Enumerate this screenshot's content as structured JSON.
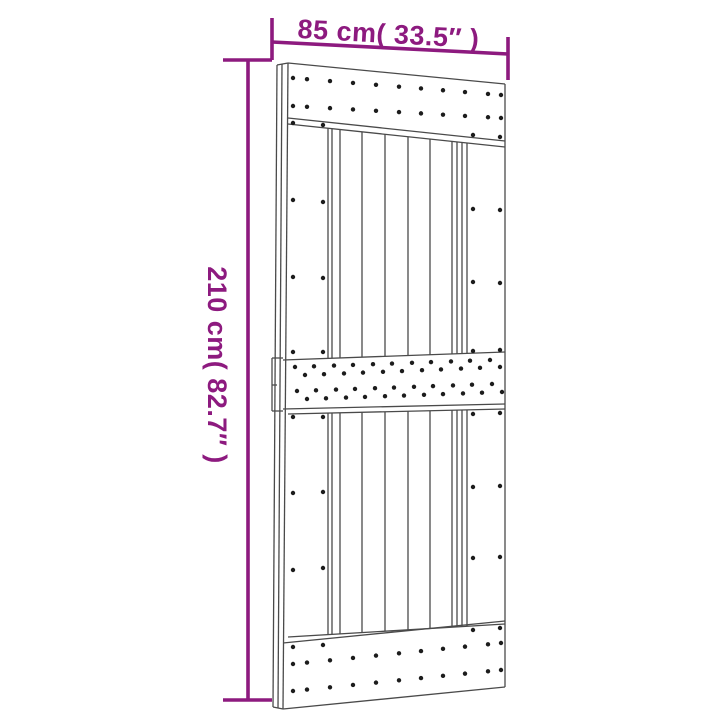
{
  "page": {
    "background": "#ffffff",
    "subject": "sliding-barn-door-dimension-diagram"
  },
  "dimensions": {
    "annotation_color": "#8d1a7f",
    "line_width": 3.6,
    "width_label": "85 cm( 33.5″ )",
    "height_label": "210 cm( 82.7″ )",
    "lines": [
      [
        272,
        42,
        508,
        54
      ],
      [
        272,
        18,
        272,
        60
      ],
      [
        508,
        37,
        508,
        80
      ],
      [
        248,
        60,
        248,
        700
      ],
      [
        223,
        60,
        272,
        60
      ],
      [
        223,
        700,
        272,
        700
      ]
    ]
  },
  "figure": {
    "name": "barn-door-line-drawing",
    "line_color": "#4a4a4a",
    "line_width": 1.3,
    "dot_color": "#1c1c1c",
    "dot_radius": 2.2,
    "door_lines": [
      [
        288,
        63,
        505,
        84
      ],
      [
        505,
        84,
        505,
        687
      ],
      [
        505,
        687,
        283,
        709
      ],
      [
        288,
        63,
        283,
        709
      ],
      [
        277,
        65,
        273,
        707
      ],
      [
        282,
        64,
        278,
        708
      ],
      [
        277,
        65,
        288,
        63
      ],
      [
        273,
        707,
        283,
        709
      ],
      [
        288,
        118,
        505,
        141
      ],
      [
        288,
        124,
        505,
        147
      ],
      [
        283,
        360,
        505,
        352
      ],
      [
        283,
        409,
        505,
        404
      ],
      [
        288,
        414,
        505,
        409
      ],
      [
        283,
        643,
        505,
        621
      ],
      [
        288,
        637,
        505,
        624
      ],
      [
        272,
        358,
        283,
        358
      ],
      [
        272,
        411,
        283,
        411
      ],
      [
        272,
        358,
        272,
        411
      ],
      [
        272,
        385,
        277,
        385
      ],
      [
        328,
        128,
        328,
        358
      ],
      [
        332,
        129,
        332,
        358
      ],
      [
        340,
        130,
        340,
        358
      ],
      [
        362,
        132,
        362,
        357
      ],
      [
        385,
        134,
        385,
        356
      ],
      [
        408,
        137,
        408,
        356
      ],
      [
        430,
        139,
        430,
        355
      ],
      [
        452,
        141,
        452,
        354
      ],
      [
        457,
        142,
        457,
        354
      ],
      [
        462,
        142,
        462,
        354
      ],
      [
        467,
        143,
        467,
        353
      ],
      [
        328,
        413,
        328,
        635
      ],
      [
        332,
        413,
        332,
        634
      ],
      [
        340,
        413,
        340,
        634
      ],
      [
        362,
        412,
        362,
        632
      ],
      [
        385,
        412,
        385,
        631
      ],
      [
        408,
        411,
        408,
        630
      ],
      [
        430,
        411,
        430,
        628
      ],
      [
        452,
        410,
        452,
        627
      ],
      [
        457,
        410,
        457,
        627
      ],
      [
        462,
        410,
        462,
        626
      ],
      [
        467,
        410,
        467,
        626
      ]
    ],
    "nail_rows": [
      {
        "xs": [
          293,
          307,
          330,
          353,
          376,
          399,
          421,
          443,
          465,
          488,
          501
        ],
        "y_first": 78,
        "y_last": 95
      },
      {
        "xs": [
          293,
          307,
          330,
          353,
          376,
          399,
          421,
          443,
          465,
          488,
          501
        ],
        "y_first": 106,
        "y_last": 118
      },
      {
        "xs": [
          293,
          307,
          330,
          353,
          376,
          399,
          421,
          443,
          465,
          488,
          501
        ],
        "y_first": 664,
        "y_last": 643
      },
      {
        "xs": [
          293,
          307,
          330,
          353,
          376,
          399,
          421,
          443,
          465,
          488,
          501
        ],
        "y_first": 691,
        "y_last": 670
      },
      {
        "xs": [
          295,
          314,
          334,
          353,
          373,
          392,
          412,
          431,
          451,
          470,
          490
        ],
        "y_first": 367,
        "y_last": 360
      },
      {
        "xs": [
          305,
          324,
          344,
          363,
          383,
          402,
          422,
          441,
          461,
          480,
          500
        ],
        "y_first": 375,
        "y_last": 367
      },
      {
        "xs": [
          297,
          316,
          336,
          355,
          375,
          394,
          414,
          433,
          453,
          472,
          492
        ],
        "y_first": 391,
        "y_last": 384
      },
      {
        "xs": [
          307,
          326,
          346,
          365,
          385,
          404,
          424,
          443,
          463,
          482,
          502
        ],
        "y_first": 399,
        "y_last": 392
      }
    ],
    "nail_dots": [
      [
        293,
        123
      ],
      [
        323,
        125
      ],
      [
        293,
        200
      ],
      [
        323,
        202
      ],
      [
        293,
        277
      ],
      [
        323,
        278
      ],
      [
        293,
        352
      ],
      [
        323,
        352
      ],
      [
        473,
        135
      ],
      [
        500,
        137
      ],
      [
        473,
        209
      ],
      [
        500,
        210
      ],
      [
        473,
        282
      ],
      [
        500,
        283
      ],
      [
        473,
        351
      ],
      [
        500,
        350
      ],
      [
        293,
        417
      ],
      [
        323,
        417
      ],
      [
        293,
        493
      ],
      [
        323,
        492
      ],
      [
        293,
        570
      ],
      [
        323,
        568
      ],
      [
        293,
        647
      ],
      [
        323,
        645
      ],
      [
        473,
        414
      ],
      [
        500,
        413
      ],
      [
        473,
        487
      ],
      [
        500,
        486
      ],
      [
        473,
        558
      ],
      [
        500,
        557
      ],
      [
        473,
        630
      ],
      [
        500,
        628
      ]
    ]
  }
}
